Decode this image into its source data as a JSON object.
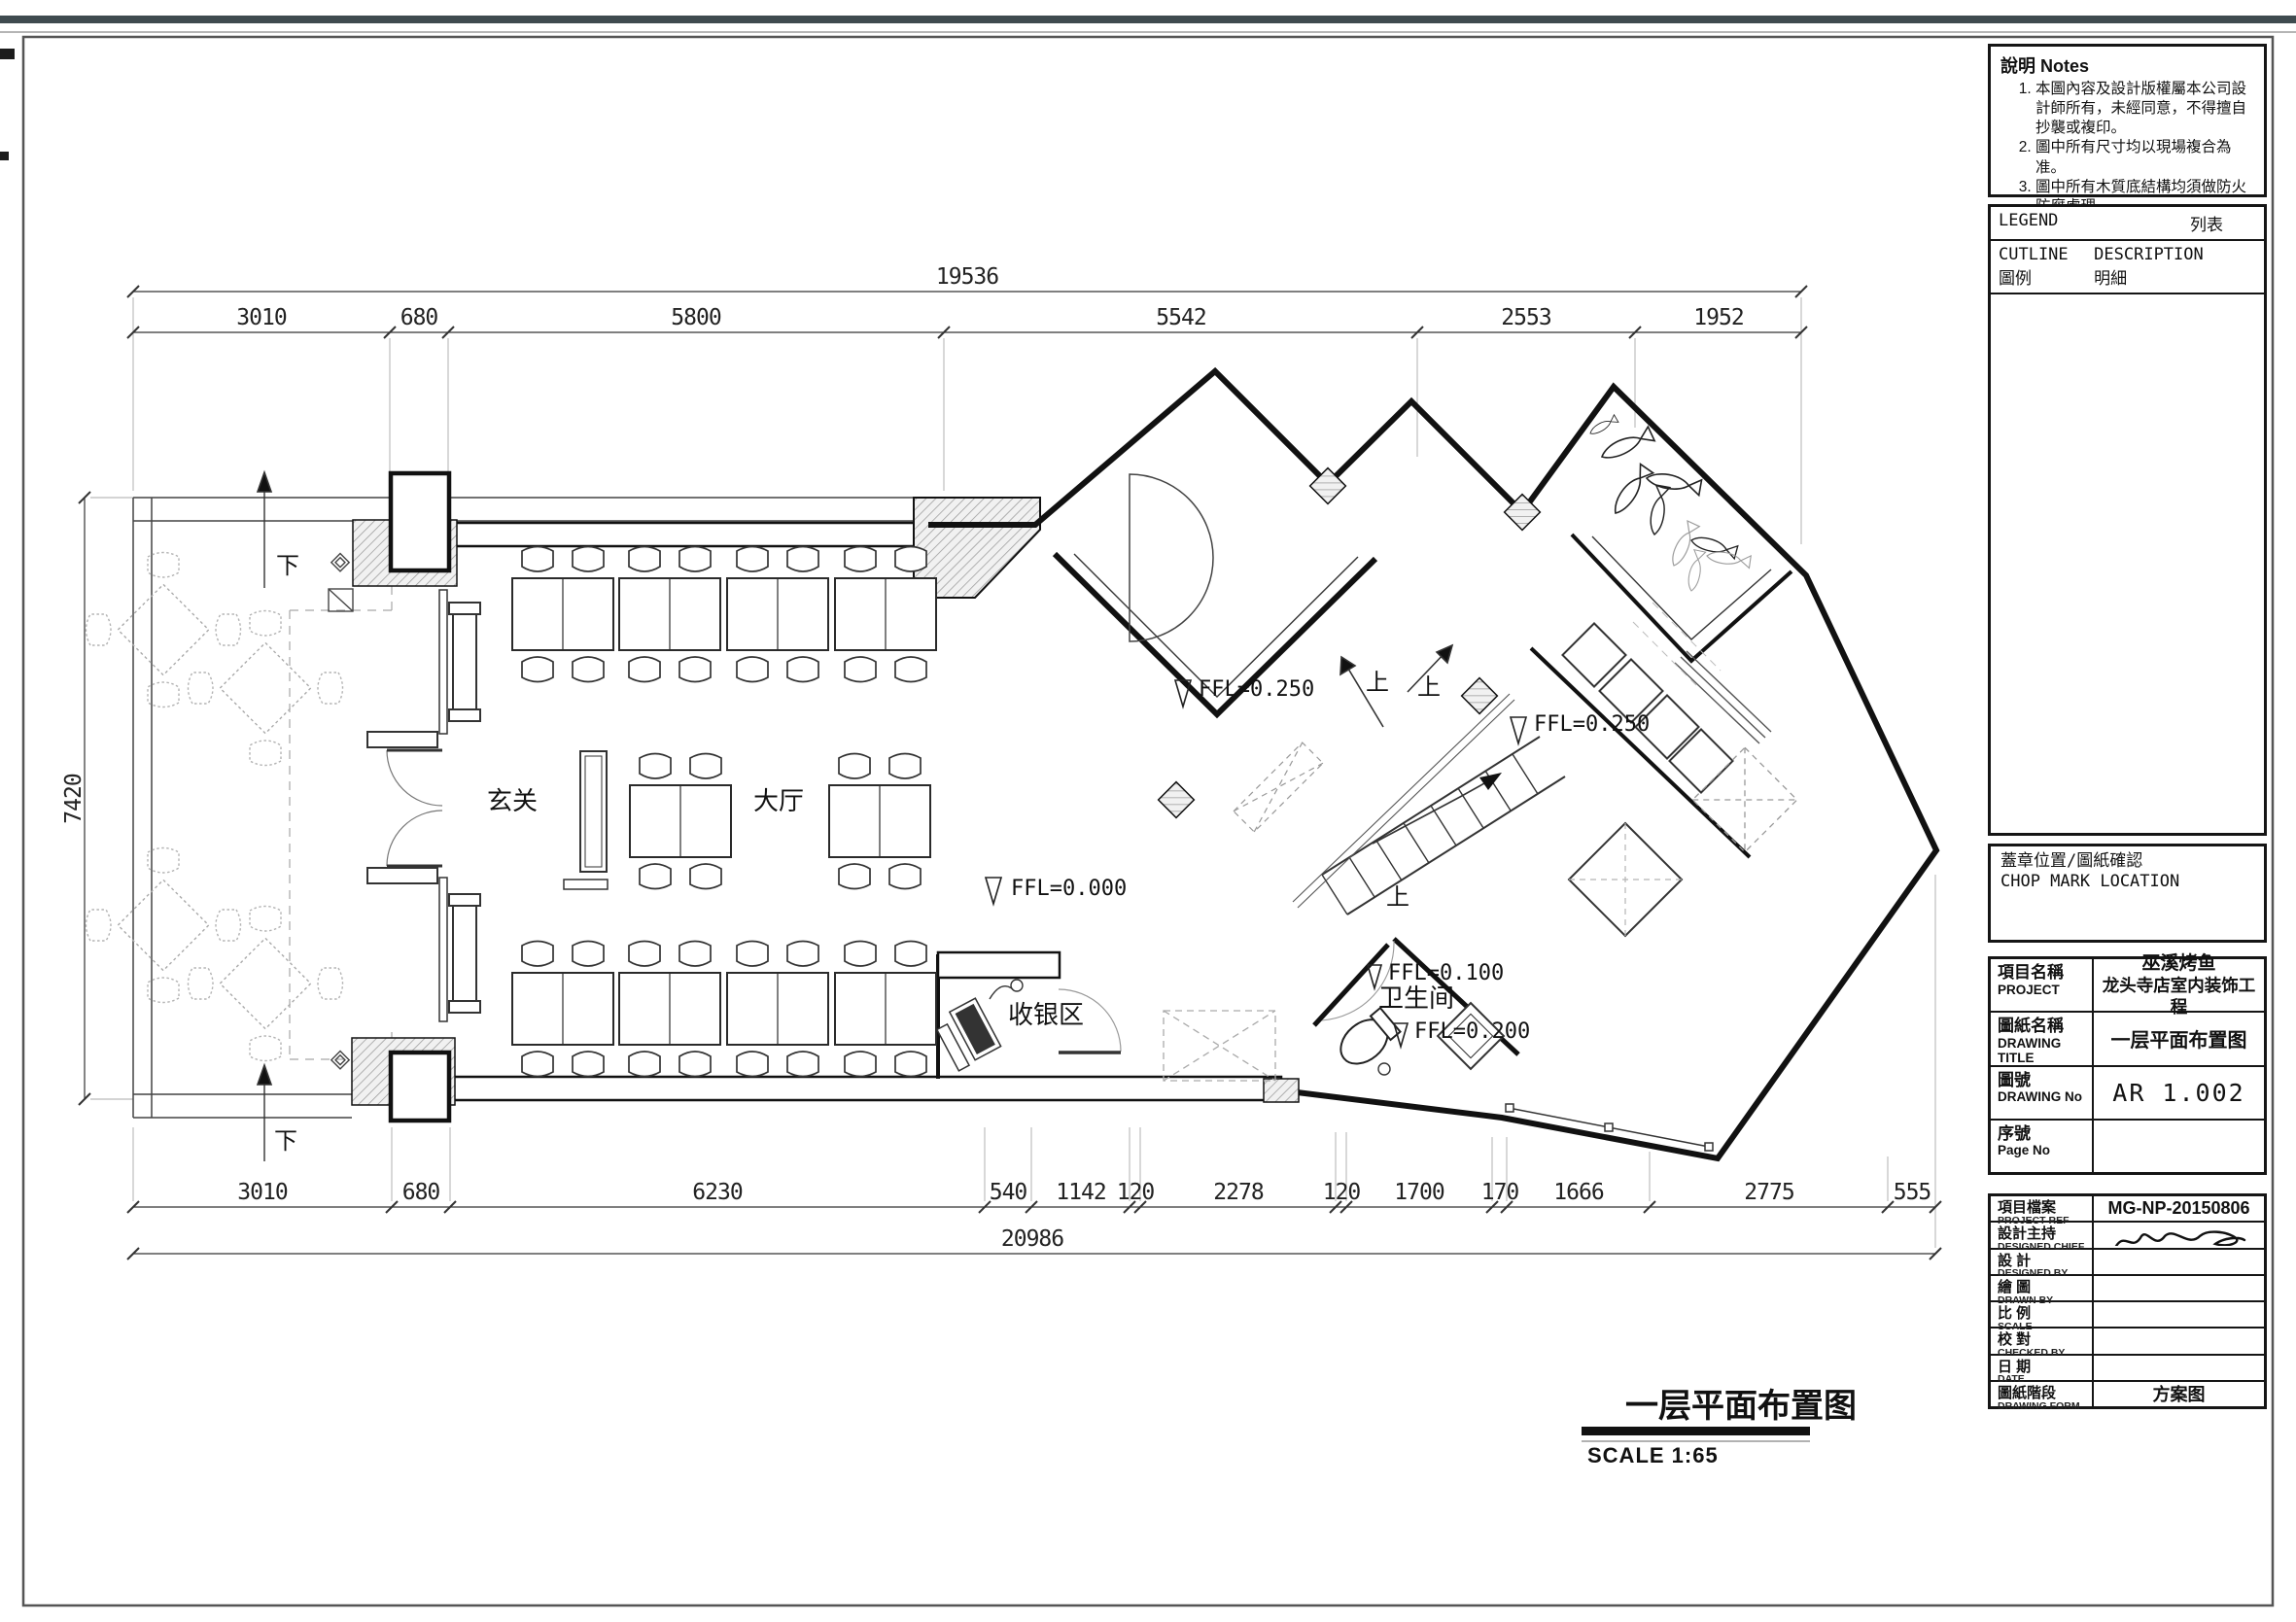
{
  "notes": {
    "title_zh": "說明",
    "title_en": "Notes",
    "items": [
      "本圖內容及設計版權屬本公司設計師所有，未經同意，不得擅自抄襲或複印。",
      "圖中所有尺寸均以現場複合為准。",
      "圖中所有木質底結構均須做防火防腐處理。",
      "若圖中內容與實際施工現場不符，應與本公司相關人員商議後，方可施工。",
      "使用本圖施工時，須與說明文件一起閱讀。"
    ]
  },
  "legend": {
    "header_en": "LEGEND",
    "header_zh": "列表",
    "col1": "CUTLINE 圖例",
    "col2": "DESCRIPTION 明細"
  },
  "chop": {
    "line1": "蓋章位置/圖紙確認",
    "line2": "CHOP MARK LOCATION"
  },
  "title_block": {
    "project": {
      "zh": "項目名稱",
      "en": "PROJECT",
      "value_line1": "巫溪烤鱼",
      "value_line2": "龙头寺店室内装饰工程"
    },
    "drawing_title": {
      "zh": "圖紙名稱",
      "en": "DRAWING  TITLE",
      "value": "一层平面布置图"
    },
    "drawing_no": {
      "zh": "圖號",
      "en": "DRAWING No",
      "value": "AR 1.002"
    },
    "page_no": {
      "zh": "序號",
      "en": "Page No",
      "value": ""
    }
  },
  "ref_block": {
    "rows": [
      {
        "zh": "項目檔案",
        "en": "PROJECT REF",
        "value": "MG-NP-20150806"
      },
      {
        "zh": "設計主持",
        "en": "DESIGNED CHIEF",
        "value": ""
      },
      {
        "zh": "設 計",
        "en": "DESIGNED BY",
        "value": ""
      },
      {
        "zh": "繪 圖",
        "en": "DRAWN BY",
        "value": ""
      },
      {
        "zh": "比 例",
        "en": "SCALE",
        "value": ""
      },
      {
        "zh": "校 對",
        "en": "CHECKED BY",
        "value": ""
      },
      {
        "zh": "日 期",
        "en": "DATE",
        "value": ""
      },
      {
        "zh": "圖紙階段",
        "en": "DRAWING FORM",
        "value": "方案图"
      }
    ]
  },
  "plan": {
    "title": "一层平面布置图",
    "scale_label": "SCALE 1:65",
    "rooms": {
      "entry": "玄关",
      "hall": "大厅",
      "cashier": "收银区",
      "wc": "卫生间"
    },
    "levels": {
      "hall": "FFL=0.000",
      "room_a": "FFL=0.250",
      "kitchen": "FFL=0.250",
      "wc_upper": "FFL=0.100",
      "wc_lower": "FFL=0.200"
    },
    "dir": {
      "up": "上",
      "down": "下"
    },
    "dims": {
      "top_overall": "19536",
      "top_segments": [
        "3010",
        "680",
        "5800",
        "5542",
        "2553",
        "1952"
      ],
      "left": "7420",
      "bottom_segments": [
        "3010",
        "680",
        "6230",
        "540",
        "1142",
        "120",
        "2278",
        "120",
        "1700",
        "170",
        "1666",
        "2775",
        "555"
      ],
      "bottom_overall": "20986"
    }
  }
}
